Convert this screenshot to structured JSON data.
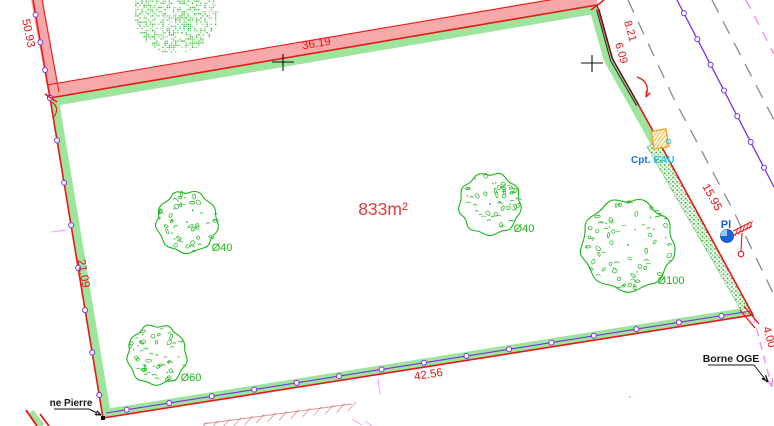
{
  "labels": {
    "dim_50_93": "50.93",
    "dim_36_19": "36.19",
    "dim_8_21": "8.21",
    "dim_6_09": "6.09",
    "dim_21_09": "21.09",
    "dim_15_95": "15.95",
    "dim_42_56": "42.56",
    "dim_4_00": "4.00",
    "area": "833m²",
    "tree_40_a": "Ø40",
    "tree_40_b": "Ø40",
    "tree_100": "Ø100",
    "tree_60": "Ø60",
    "borne_oge": "Borne OGE",
    "borne_pierre": "ne Pierre",
    "cpt": "Cpt.",
    "eau": "EAU",
    "pl": "Pl"
  },
  "colors": {
    "boundary_red": "#ea1515",
    "dim_red": "#e41414",
    "pink_band": "#f7a8a8",
    "green_band": "#9de49d",
    "tree_green": "#17b517",
    "purple": "#7c2fe0",
    "gray_dash": "#8a8a8a",
    "pink_dash": "#ff86ec",
    "magenta": "#ff5fff",
    "blue": "#1560d4",
    "cyan": "#2ac0f0",
    "orange": "#eda31c",
    "black": "#161616",
    "hatch_red": "#c05050"
  },
  "plan": {
    "boundary": [
      [
        50,
        98
      ],
      [
        597,
        5
      ],
      [
        612,
        58
      ],
      [
        638,
        104
      ],
      [
        658,
        140
      ],
      [
        753,
        315
      ],
      [
        103,
        418
      ]
    ],
    "pink_band_top": [
      [
        50,
        98
      ],
      [
        597,
        5
      ],
      [
        597,
        -9
      ],
      [
        50,
        84
      ]
    ],
    "pink_band_nw": [
      [
        31,
        0
      ],
      [
        49,
        98
      ],
      [
        60,
        94
      ],
      [
        43,
        0
      ]
    ],
    "outer_red_top": [
      [
        47,
        85
      ],
      [
        597,
        -8
      ]
    ],
    "outer_red_nw": [
      [
        42,
        0
      ],
      [
        59,
        92
      ]
    ],
    "nw_line": [
      [
        33,
        0
      ],
      [
        50,
        98
      ]
    ],
    "left_edge": [
      [
        50,
        98
      ],
      [
        103,
        418
      ]
    ],
    "bottom_purple": [
      [
        106,
        413
      ],
      [
        751,
        311
      ]
    ],
    "utility_purple": [
      [
        677,
        0
      ],
      [
        774,
        187
      ]
    ],
    "black_double": [
      [
        599,
        9
      ],
      [
        613,
        60
      ],
      [
        639,
        105
      ]
    ],
    "hedge": [
      [
        658,
        140
      ],
      [
        753,
        315
      ],
      [
        742,
        312
      ],
      [
        647,
        147
      ]
    ],
    "gray_dash_a": [
      [
        628,
        0
      ],
      [
        673,
        97
      ],
      [
        733,
        210
      ],
      [
        774,
        295
      ]
    ],
    "gray_dash_b": [
      [
        712,
        0
      ],
      [
        774,
        120
      ]
    ],
    "pink_dash_top": [
      [
        746,
        0
      ],
      [
        774,
        54
      ]
    ],
    "pink_dash_borne": [
      [
        753,
        315
      ],
      [
        771,
        384
      ]
    ],
    "crosses": [
      [
        283,
        62
      ],
      [
        592,
        63
      ]
    ],
    "trees": [
      {
        "cx": 187,
        "cy": 222,
        "r": 32,
        "style": "leafy"
      },
      {
        "cx": 490,
        "cy": 204,
        "r": 32,
        "style": "leafy"
      },
      {
        "cx": 628,
        "cy": 245,
        "r": 48,
        "style": "leafy"
      },
      {
        "cx": 157,
        "cy": 355,
        "r": 31,
        "style": "leafy"
      },
      {
        "cx": 175,
        "cy": 11,
        "r": 42,
        "style": "dense"
      }
    ],
    "water_meter": {
      "x": 660,
      "y": 139,
      "w": 15,
      "h": 18,
      "rot": -10
    },
    "hydrant": {
      "cx": 727,
      "cy": 236,
      "r": 6.5
    },
    "neighbor_hatch": [
      [
        203,
        424
      ],
      [
        352,
        404
      ]
    ]
  }
}
